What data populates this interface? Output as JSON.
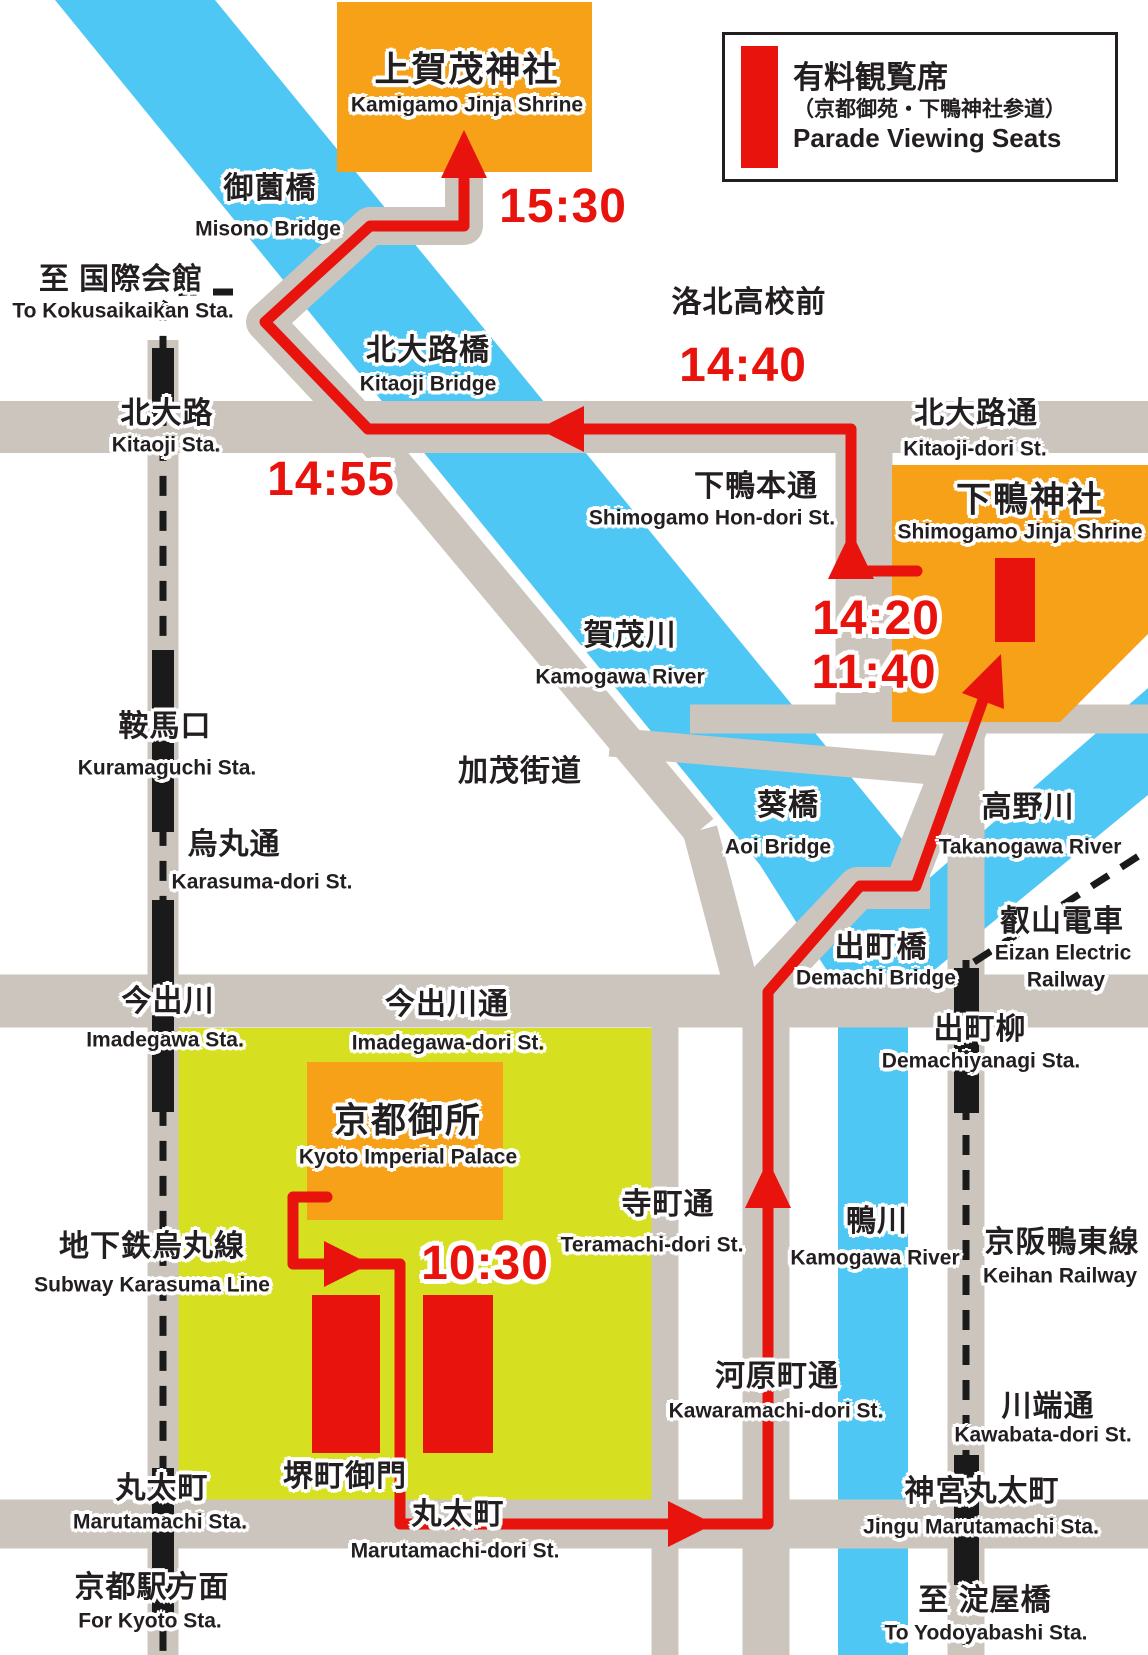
{
  "legend": {
    "title": "有料観覧席",
    "subtitle": "（京都御苑・下鴨神社参道）",
    "caption": "Parade Viewing Seats",
    "swatch_meaning": "paid-viewing-seat-area"
  },
  "colors": {
    "route_red": "#e8130d",
    "shrine_orange": "#f6a117",
    "park_green": "#d7df21",
    "river_blue": "#4fc7f5",
    "road_gray": "#ccc5be",
    "rail_black": "#1a1a1a",
    "text_black": "#231f20"
  },
  "map": {
    "labels": [
      {
        "id": "kamigamo-shrine",
        "text": "上賀茂神社",
        "kind": "jpbig",
        "x": 467,
        "y": 70
      },
      {
        "id": "kamigamo-shrine-en",
        "text": "Kamigamo Jinja Shrine",
        "kind": "en",
        "x": 467,
        "y": 105
      },
      {
        "id": "time-1530",
        "text": "15:30",
        "kind": "time",
        "x": 563,
        "y": 207
      },
      {
        "id": "misono-bridge",
        "text": "御薗橋",
        "kind": "jp",
        "x": 270,
        "y": 189
      },
      {
        "id": "misono-bridge-en",
        "text": "Misono Bridge",
        "kind": "en",
        "x": 268,
        "y": 229
      },
      {
        "id": "kokusaikaikan",
        "text": "至 国際会館",
        "kind": "jp",
        "x": 121,
        "y": 280
      },
      {
        "id": "kokusaikaikan-en",
        "text": "To Kokusaikaikan Sta.",
        "kind": "en",
        "x": 123,
        "y": 311
      },
      {
        "id": "rakuhoku-koko-mae",
        "text": "洛北高校前",
        "kind": "jp",
        "x": 749,
        "y": 303
      },
      {
        "id": "time-1440",
        "text": "14:40",
        "kind": "time",
        "x": 743,
        "y": 366
      },
      {
        "id": "kitaoji-bridge",
        "text": "北大路橋",
        "kind": "jp",
        "x": 428,
        "y": 351
      },
      {
        "id": "kitaoji-bridge-en",
        "text": "Kitaoji Bridge",
        "kind": "en",
        "x": 428,
        "y": 384
      },
      {
        "id": "kitaoji-sta",
        "text": "北大路",
        "kind": "jp",
        "x": 167,
        "y": 414
      },
      {
        "id": "kitaoji-sta-en",
        "text": "Kitaoji Sta.",
        "kind": "en",
        "x": 166,
        "y": 445
      },
      {
        "id": "time-1455",
        "text": "14:55",
        "kind": "time",
        "x": 331,
        "y": 480
      },
      {
        "id": "kitaoji-dori",
        "text": "北大路通",
        "kind": "jp",
        "x": 976,
        "y": 414
      },
      {
        "id": "kitaoji-dori-en",
        "text": "Kitaoji-dori St.",
        "kind": "en",
        "x": 975,
        "y": 449
      },
      {
        "id": "shimogamo-hondori",
        "text": "下鴨本通",
        "kind": "jp",
        "x": 756,
        "y": 487
      },
      {
        "id": "shimogamo-hondori-en",
        "text": "Shimogamo Hon-dori St.",
        "kind": "en",
        "x": 712,
        "y": 518
      },
      {
        "id": "shimogamo-shrine",
        "text": "下鴨神社",
        "kind": "jpbig",
        "x": 1030,
        "y": 500
      },
      {
        "id": "shimogamo-shrine-en",
        "text": "Shimogamo Jinja Shrine",
        "kind": "en",
        "x": 1020,
        "y": 532
      },
      {
        "id": "time-1420",
        "text": "14:20",
        "kind": "time",
        "x": 876,
        "y": 619
      },
      {
        "id": "time-1140",
        "text": "11:40",
        "kind": "time",
        "x": 874,
        "y": 673
      },
      {
        "id": "kamogawa-river",
        "text": "賀茂川",
        "kind": "jp",
        "x": 630,
        "y": 636
      },
      {
        "id": "kamogawa-river-en",
        "text": "Kamogawa River",
        "kind": "en",
        "x": 620,
        "y": 677
      },
      {
        "id": "kuramaguchi-sta",
        "text": "鞍馬口",
        "kind": "jp",
        "x": 165,
        "y": 727
      },
      {
        "id": "kuramaguchi-sta-en",
        "text": "Kuramaguchi Sta.",
        "kind": "en",
        "x": 167,
        "y": 768
      },
      {
        "id": "kamo-kaido",
        "text": "加茂街道",
        "kind": "jp",
        "x": 520,
        "y": 772
      },
      {
        "id": "aoi-bridge",
        "text": "葵橋",
        "kind": "jp",
        "x": 788,
        "y": 806
      },
      {
        "id": "aoi-bridge-en",
        "text": "Aoi Bridge",
        "kind": "en",
        "x": 778,
        "y": 847
      },
      {
        "id": "takanogawa-river",
        "text": "高野川",
        "kind": "jp",
        "x": 1028,
        "y": 808
      },
      {
        "id": "takanogawa-river-en",
        "text": "Takanogawa River",
        "kind": "en",
        "x": 1030,
        "y": 847
      },
      {
        "id": "karasuma-dori",
        "text": "烏丸通",
        "kind": "jp",
        "x": 234,
        "y": 845
      },
      {
        "id": "karasuma-dori-en",
        "text": "Karasuma-dori St.",
        "kind": "en",
        "x": 262,
        "y": 882
      },
      {
        "id": "demachi-bridge",
        "text": "出町橋",
        "kind": "jp",
        "x": 881,
        "y": 948
      },
      {
        "id": "demachi-bridge-en",
        "text": "Demachi Bridge",
        "kind": "en",
        "x": 876,
        "y": 978
      },
      {
        "id": "eizan-railway",
        "text": "叡山電車",
        "kind": "jp",
        "x": 1062,
        "y": 922
      },
      {
        "id": "eizan-railway-en1",
        "text": "Eizan Electric",
        "kind": "en",
        "x": 1063,
        "y": 953
      },
      {
        "id": "eizan-railway-en2",
        "text": "Railway",
        "kind": "en",
        "x": 1066,
        "y": 980
      },
      {
        "id": "demachiyanagi-sta",
        "text": "出町柳",
        "kind": "jp",
        "x": 980,
        "y": 1030
      },
      {
        "id": "demachiyanagi-sta-en",
        "text": "Demachiyanagi Sta.",
        "kind": "en",
        "x": 981,
        "y": 1061
      },
      {
        "id": "imadegawa-sta",
        "text": "今出川",
        "kind": "jp",
        "x": 168,
        "y": 1002
      },
      {
        "id": "imadegawa-sta-en",
        "text": "Imadegawa Sta.",
        "kind": "en",
        "x": 165,
        "y": 1040
      },
      {
        "id": "imadegawa-dori",
        "text": "今出川通",
        "kind": "jp",
        "x": 447,
        "y": 1005
      },
      {
        "id": "imadegawa-dori-en",
        "text": "Imadegawa-dori St.",
        "kind": "en",
        "x": 448,
        "y": 1043
      },
      {
        "id": "kyoto-gosho",
        "text": "京都御所",
        "kind": "jpbig",
        "x": 408,
        "y": 1121
      },
      {
        "id": "kyoto-gosho-en",
        "text": "Kyoto Imperial Palace",
        "kind": "en",
        "x": 408,
        "y": 1157
      },
      {
        "id": "subway-karasuma",
        "text": "地下鉄烏丸線",
        "kind": "jp",
        "x": 152,
        "y": 1247
      },
      {
        "id": "subway-karasuma-en",
        "text": "Subway Karasuma Line",
        "kind": "en",
        "x": 152,
        "y": 1285
      },
      {
        "id": "time-1030",
        "text": "10:30",
        "kind": "time",
        "x": 485,
        "y": 1264
      },
      {
        "id": "teramachi-dori",
        "text": "寺町通",
        "kind": "jp",
        "x": 668,
        "y": 1205
      },
      {
        "id": "teramachi-dori-en",
        "text": "Teramachi-dori St.",
        "kind": "en",
        "x": 652,
        "y": 1245
      },
      {
        "id": "kamogawa-river-2",
        "text": "鴨川",
        "kind": "jp",
        "x": 877,
        "y": 1222
      },
      {
        "id": "kamogawa-river-2-en",
        "text": "Kamogawa River",
        "kind": "en",
        "x": 875,
        "y": 1258
      },
      {
        "id": "keihan-railway",
        "text": "京阪鴨東線",
        "kind": "jp",
        "x": 1062,
        "y": 1243
      },
      {
        "id": "keihan-railway-en",
        "text": "Keihan Railway",
        "kind": "en",
        "x": 1060,
        "y": 1276
      },
      {
        "id": "kawaramachi-dori",
        "text": "河原町通",
        "kind": "jp",
        "x": 777,
        "y": 1377
      },
      {
        "id": "kawaramachi-dori-en",
        "text": "Kawaramachi-dori St.",
        "kind": "en",
        "x": 776,
        "y": 1411
      },
      {
        "id": "kawabata-dori",
        "text": "川端通",
        "kind": "jp",
        "x": 1048,
        "y": 1407
      },
      {
        "id": "kawabata-dori-en",
        "text": "Kawabata-dori St.",
        "kind": "en",
        "x": 1043,
        "y": 1435
      },
      {
        "id": "sakaimachi-gomon",
        "text": "堺町御門",
        "kind": "jp",
        "x": 345,
        "y": 1477
      },
      {
        "id": "marutamachi-sta",
        "text": "丸太町",
        "kind": "jp",
        "x": 162,
        "y": 1489
      },
      {
        "id": "marutamachi-sta-en",
        "text": "Marutamachi Sta.",
        "kind": "en",
        "x": 160,
        "y": 1522
      },
      {
        "id": "marutamachi-dori",
        "text": "丸太町",
        "kind": "jp",
        "x": 458,
        "y": 1515
      },
      {
        "id": "marutamachi-dori-en",
        "text": "Marutamachi-dori St.",
        "kind": "en",
        "x": 455,
        "y": 1551
      },
      {
        "id": "jingu-marutamachi-sta",
        "text": "神宮丸太町",
        "kind": "jp",
        "x": 982,
        "y": 1492
      },
      {
        "id": "jingu-marutamachi-sta-en",
        "text": "Jingu Marutamachi Sta.",
        "kind": "en",
        "x": 981,
        "y": 1527
      },
      {
        "id": "kyoto-sta-homen",
        "text": "京都駅方面",
        "kind": "jp",
        "x": 152,
        "y": 1588
      },
      {
        "id": "kyoto-sta-homen-en",
        "text": "For Kyoto Sta.",
        "kind": "en",
        "x": 150,
        "y": 1621
      },
      {
        "id": "yodoyabashi",
        "text": "至 淀屋橋",
        "kind": "jp",
        "x": 985,
        "y": 1601
      },
      {
        "id": "yodoyabashi-en",
        "text": "To Yodoyabashi Sta.",
        "kind": "en",
        "x": 986,
        "y": 1633
      }
    ]
  }
}
